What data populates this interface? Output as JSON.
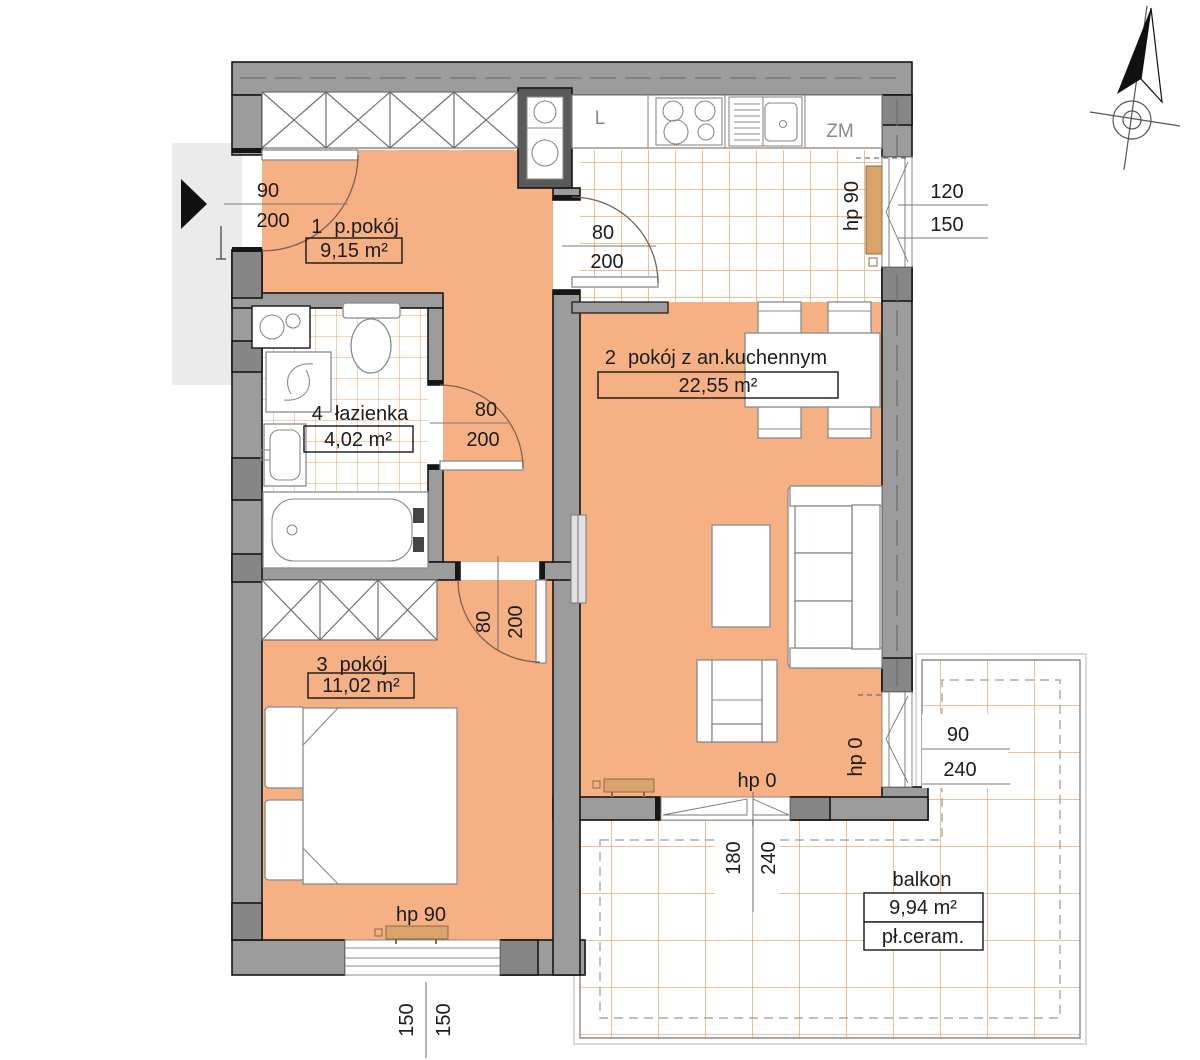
{
  "plan": {
    "rooms": [
      {
        "number": "1",
        "name": "p.pokój",
        "area": "9,15 m²"
      },
      {
        "number": "2",
        "name": "pokój z an.kuchennym",
        "area": "22,55 m²"
      },
      {
        "number": "3",
        "name": "pokój",
        "area": "11,02 m²"
      },
      {
        "number": "4",
        "name": "łazienka",
        "area": "4,02 m²"
      }
    ],
    "balcony": {
      "name": "balkon",
      "area": "9,94 m²",
      "material": "pł.ceram."
    },
    "kitchen": {
      "fridge_label": "L",
      "dishwasher_label": "ZM"
    },
    "openings": {
      "entrance_door": {
        "w": "90",
        "h": "200"
      },
      "kitchen_door": {
        "w": "80",
        "h": "200"
      },
      "bathroom_door": {
        "w": "80",
        "h": "200"
      },
      "room3_door": {
        "w": "80",
        "h": "200"
      },
      "kitchen_window": {
        "sill": "hp 90",
        "w": "120",
        "h": "150"
      },
      "side_window": {
        "sill": "hp 0",
        "w": "90",
        "h": "240"
      },
      "balcony_door": {
        "sill": "hp 0",
        "w": "180",
        "h": "240"
      },
      "room3_window": {
        "sill": "hp 90",
        "w": "150",
        "h": "150"
      }
    },
    "colors": {
      "floor_orange": "#F5B183",
      "tile_line": "#EB9A5D",
      "wall_gray": "#9C9C9C",
      "radiator_tan": "#D9A36A",
      "corridor_gray": "#EBEBEB"
    }
  }
}
